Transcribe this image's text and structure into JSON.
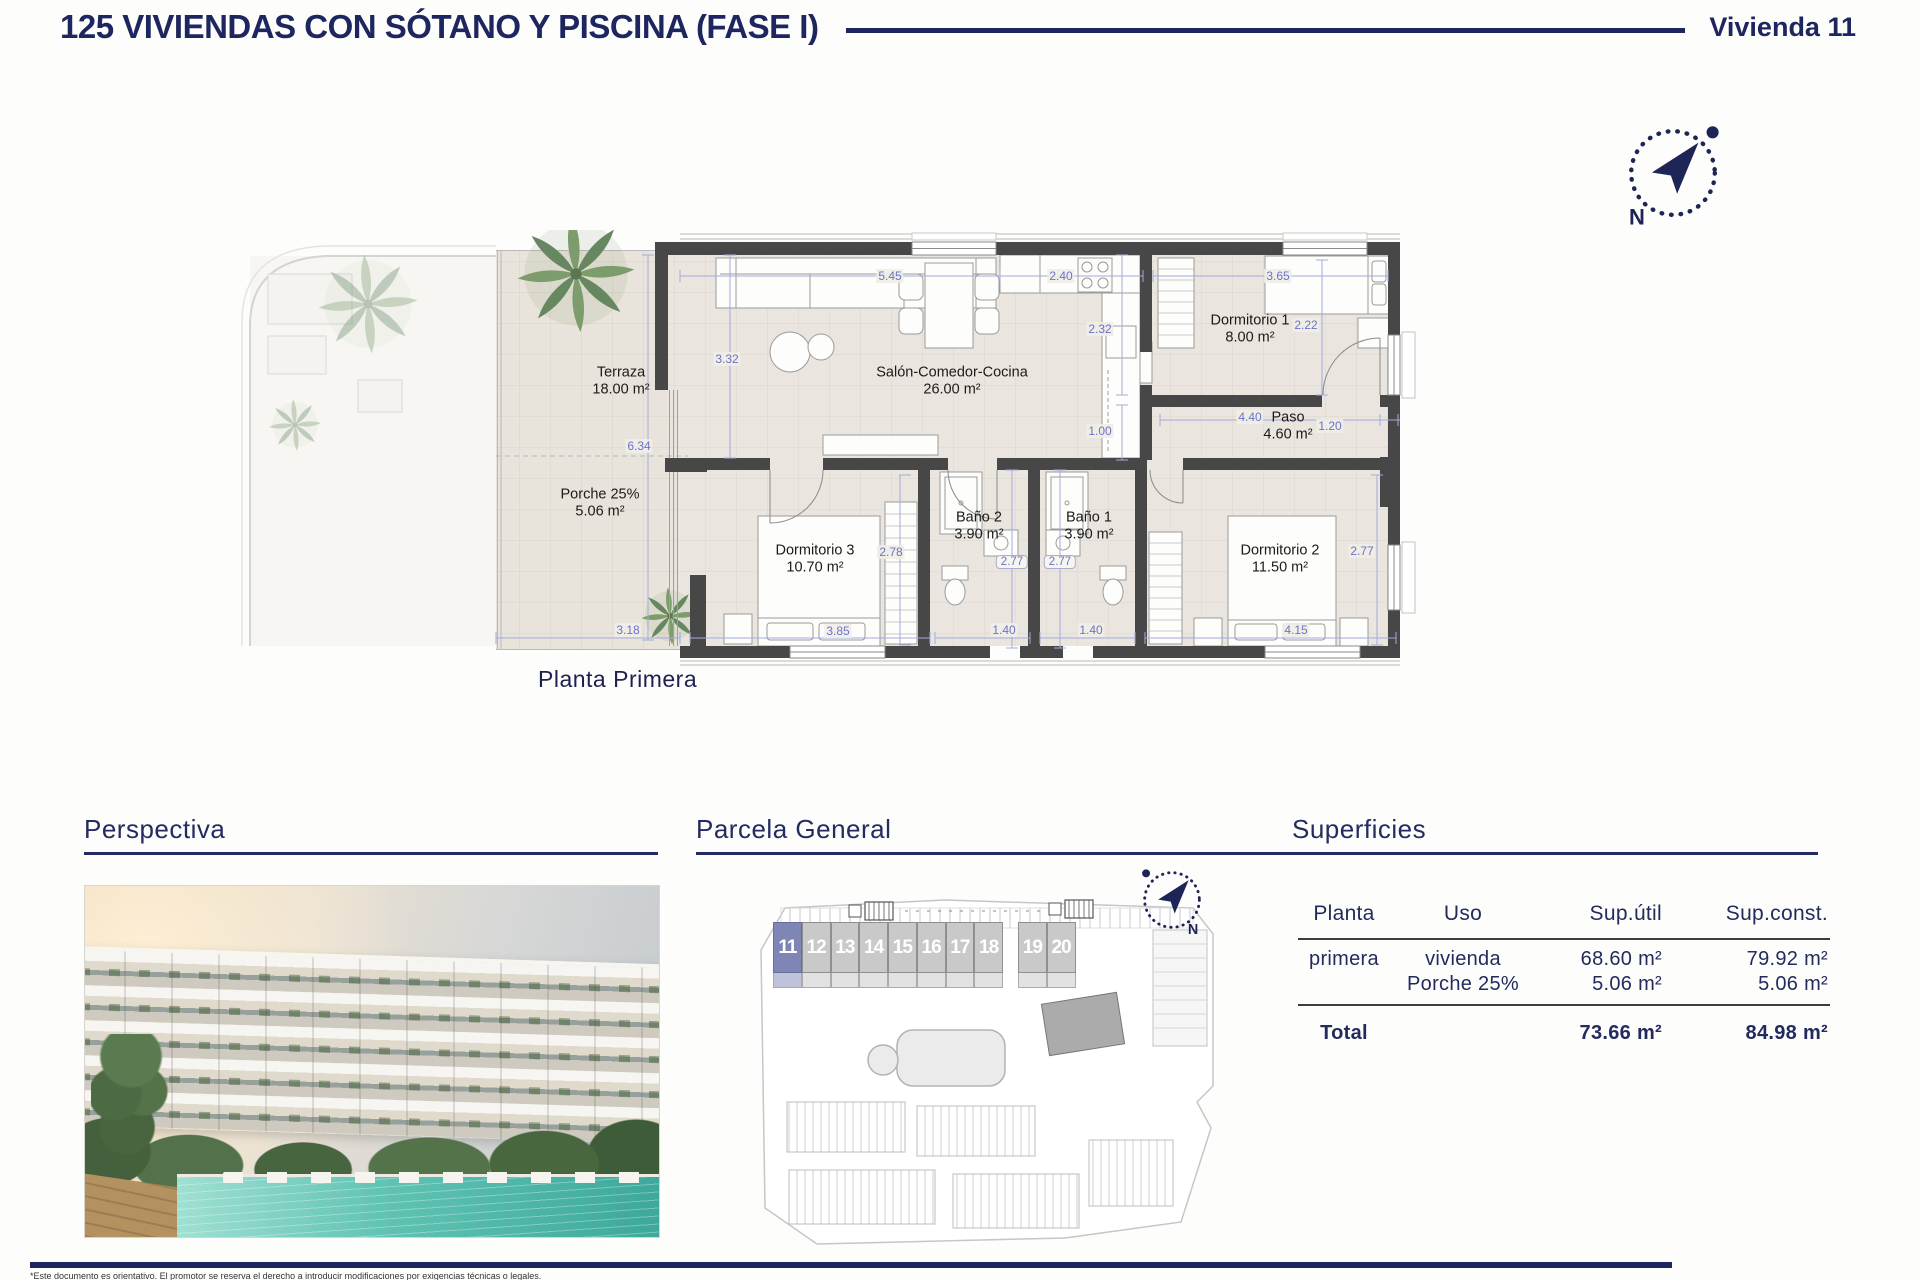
{
  "header": {
    "title": "125 VIVIENDAS CON SÓTANO Y PISCINA (FASE I)",
    "unit_label": "Vivienda 11"
  },
  "compass": {
    "north": "N"
  },
  "floorplan": {
    "caption": "Planta Primera",
    "rooms": [
      {
        "name": "Terraza",
        "area": "18.00 m²",
        "x": 381,
        "y": 152
      },
      {
        "name": "Porche 25%",
        "area": "5.06 m²",
        "x": 360,
        "y": 274
      },
      {
        "name": "Salón-Comedor-Cocina",
        "area": "26.00 m²",
        "x": 712,
        "y": 152
      },
      {
        "name": "Dormitorio 1",
        "area": "8.00 m²",
        "x": 1010,
        "y": 100
      },
      {
        "name": "Paso",
        "area": "4.60 m²",
        "x": 1048,
        "y": 197
      },
      {
        "name": "Dormitorio 3",
        "area": "10.70 m²",
        "x": 575,
        "y": 330
      },
      {
        "name": "Baño 2",
        "area": "3.90 m²",
        "x": 739,
        "y": 297
      },
      {
        "name": "Baño 1",
        "area": "3.90 m²",
        "x": 849,
        "y": 297
      },
      {
        "name": "Dormitorio 2",
        "area": "11.50 m²",
        "x": 1040,
        "y": 330
      }
    ],
    "dimensions": [
      {
        "v": "5.45",
        "x": 650,
        "y": 46
      },
      {
        "v": "2.40",
        "x": 821,
        "y": 46
      },
      {
        "v": "3.65",
        "x": 1038,
        "y": 46
      },
      {
        "v": "3.32",
        "x": 487,
        "y": 129
      },
      {
        "v": "2.32",
        "x": 860,
        "y": 99
      },
      {
        "v": "2.22",
        "x": 1066,
        "y": 95
      },
      {
        "v": "1.00",
        "x": 860,
        "y": 201
      },
      {
        "v": "4.40",
        "x": 1010,
        "y": 187
      },
      {
        "v": "1.20",
        "x": 1090,
        "y": 196
      },
      {
        "v": "6.34",
        "x": 399,
        "y": 216
      },
      {
        "v": "2.78",
        "x": 651,
        "y": 322
      },
      {
        "v": "2.77",
        "x": 772,
        "y": 332,
        "boxed": true
      },
      {
        "v": "2.77",
        "x": 820,
        "y": 332,
        "boxed": true
      },
      {
        "v": "2.77",
        "x": 1122,
        "y": 321
      },
      {
        "v": "3.18",
        "x": 388,
        "y": 400
      },
      {
        "v": "3.85",
        "x": 598,
        "y": 401
      },
      {
        "v": "1.40",
        "x": 764,
        "y": 400
      },
      {
        "v": "1.40",
        "x": 851,
        "y": 400
      },
      {
        "v": "4.15",
        "x": 1056,
        "y": 400
      }
    ]
  },
  "sections": {
    "perspectiva": {
      "heading": "Perspectiva"
    },
    "parcela": {
      "heading": "Parcela General",
      "units": [
        {
          "n": "11",
          "hl": true
        },
        {
          "n": "12"
        },
        {
          "n": "13"
        },
        {
          "n": "14"
        },
        {
          "n": "15"
        },
        {
          "n": "16"
        },
        {
          "n": "17"
        },
        {
          "n": "18"
        },
        {
          "spacer": true
        },
        {
          "n": "19"
        },
        {
          "n": "20"
        }
      ]
    },
    "superficies": {
      "heading": "Superficies",
      "columns": [
        "Planta",
        "Uso",
        "Sup.útil",
        "Sup.const."
      ],
      "rows": [
        {
          "planta": "primera",
          "uso": "vivienda",
          "util": "68.60 m²",
          "const": "79.92 m²"
        },
        {
          "planta": "",
          "uso": "Porche 25%",
          "util": "5.06 m²",
          "const": "5.06 m²"
        }
      ],
      "total": {
        "label": "Total",
        "util": "73.66 m²",
        "const": "84.98 m²"
      }
    }
  },
  "footer": {
    "disclaimer": "*Este documento es orientativo. El promotor se reserva el derecho a introducir modificaciones por exigencias técnicas o legales."
  }
}
